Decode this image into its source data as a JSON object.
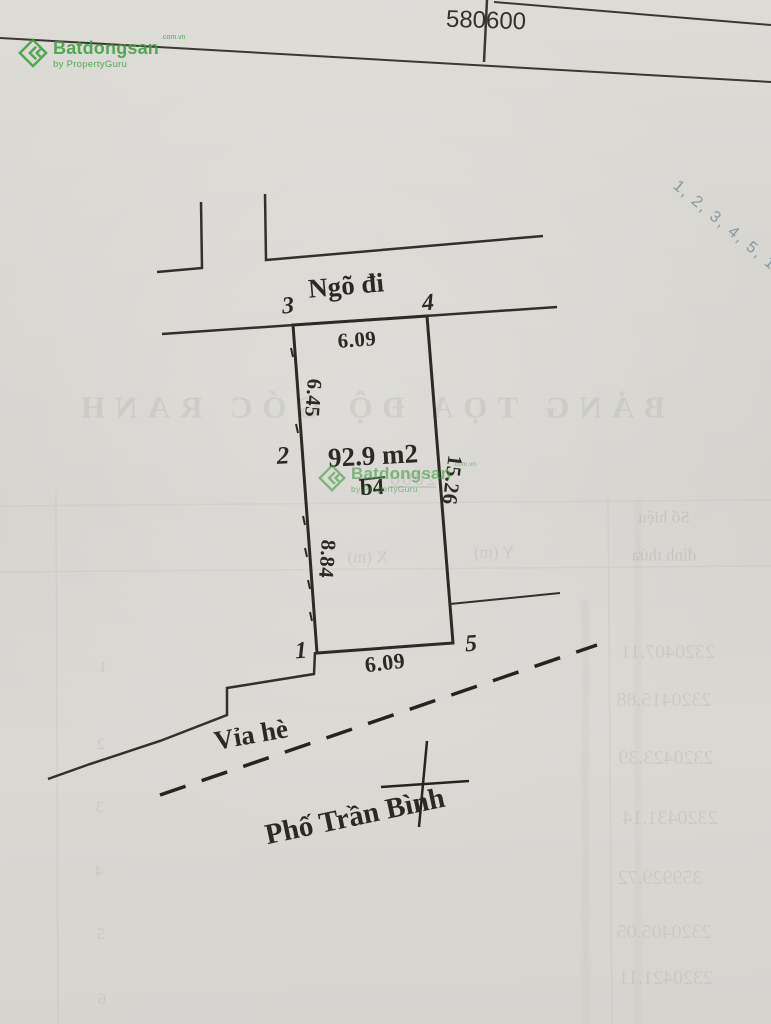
{
  "header": {
    "grid_label": "580600"
  },
  "watermark": {
    "brand": "Batdongsan",
    "domain_suffix": ".com.vn",
    "byline": "by PropertyGuru",
    "color": "#3a9e3e"
  },
  "plot": {
    "area_label": "92.9 m2",
    "lot_label": "b4",
    "vertices": {
      "v1": "1",
      "v2": "2",
      "v3": "3",
      "v4": "4",
      "v5": "5"
    },
    "dimensions": {
      "top": "6.09",
      "left_upper": "6.45",
      "left_lower": "8.84",
      "right": "15.26",
      "bottom": "6.09"
    }
  },
  "streets": {
    "alley": "Ngõ đi",
    "sidewalk": "Vỉa hè",
    "street": "Phố Trần Bình"
  },
  "annotations": {
    "handwritten_sequence": "1, 2, 3, 4, 5, 1."
  },
  "bleedthrough": {
    "title": "BẢNG TỌA ĐỘ GÓC RANH",
    "year": "2000",
    "col_id_1": "Số hiệu",
    "col_id_2": "đỉnh thửa",
    "col_x": "X (m)",
    "col_y": "Y (m)",
    "row_numbers": [
      "1",
      "2",
      "3",
      "4",
      "5",
      "6"
    ],
    "coords": [
      "2320407.11",
      "2320415.88",
      "2320423.39",
      "2320431.14",
      "359929.72",
      "2320405.05",
      "2320421.11"
    ]
  }
}
